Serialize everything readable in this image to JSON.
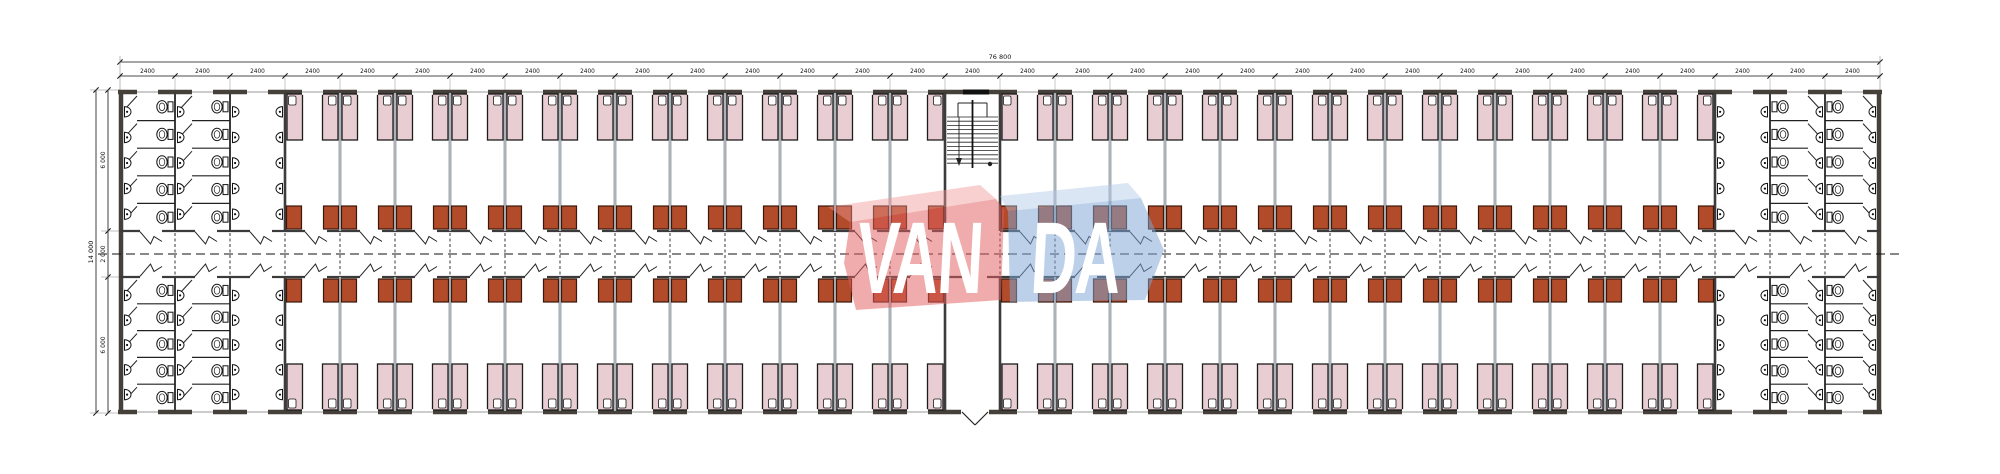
{
  "drawing": {
    "type": "architectural-floor-plan",
    "dimensions": {
      "overall_width_label": "76 800",
      "bay_label": "2400",
      "bay_count": 32,
      "overall_depth_label": "14 000",
      "depth_segment_labels": [
        "6 000",
        "2 000",
        "6 000"
      ]
    },
    "watermark": {
      "part1": "VAN",
      "part2": "DA"
    },
    "layout_counts": {
      "rooms_top_row": 25,
      "rooms_bottom_row": 25,
      "beds_per_room": 2,
      "bathroom_bays_per_end": 3,
      "toilet_stalls_per_column": 5,
      "washbasins_per_column": 5
    },
    "colors": {
      "background": "#ffffff",
      "outer_wall": "#45403a",
      "zone_wall": "#3c3c3c",
      "partition": "#64727f",
      "corridor_wall": "#3b3b3b",
      "bed_fill": "#e8ced2",
      "bed_stroke": "#1c1c1c",
      "pillow_fill": "#ffffff",
      "cabinet_fill": "#b14b29",
      "cabinet_stroke": "#3a180b",
      "fixture_stroke": "#141414",
      "fixture_fill": "#ffffff",
      "dim_text": "#111111",
      "dash_line": "#111111",
      "window_line": "#999999",
      "logo_red": "rgba(226,96,96,0.52)",
      "logo_red_top": "rgba(240,150,150,0.45)",
      "logo_blue": "rgba(127,167,212,0.52)",
      "logo_blue_top": "rgba(175,200,230,0.45)",
      "logo_text": "#ffffff"
    }
  }
}
